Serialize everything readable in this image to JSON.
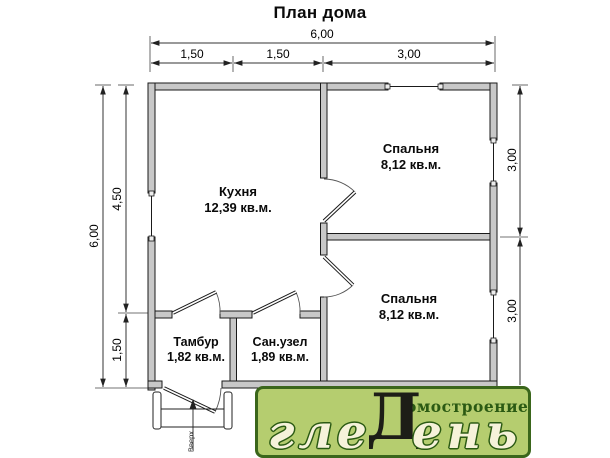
{
  "title": "План дома",
  "dims": {
    "top_total": "6,00",
    "top_seg1": "1,50",
    "top_seg2": "1,50",
    "top_seg3": "3,00",
    "left_total": "6,00",
    "left_seg1": "4,50",
    "left_seg2": "1,50",
    "right_seg1": "3,00",
    "right_seg2": "3,00"
  },
  "rooms": {
    "kitchen": {
      "name": "Кухня",
      "area": "12,39 кв.м."
    },
    "bedroom1": {
      "name": "Спальня",
      "area": "8,12 кв.м."
    },
    "bedroom2": {
      "name": "Спальня",
      "area": "8,12 кв.м."
    },
    "tambour": {
      "name": "Тамбур",
      "area": "1,82 кв.м."
    },
    "bathroom": {
      "name": "Сан.узел",
      "area": "1,89 кв.м."
    }
  },
  "stairs": {
    "direction_label": "Вверх"
  },
  "logo": {
    "brand_part1": "гле",
    "brand_letter_d": "Д",
    "brand_part2": "ень",
    "subtitle": "омостроение",
    "bg_color": "#b5cd6f",
    "border_color": "#3a661b",
    "letter_color": "#f6f2da",
    "dark_letter_color": "#1d1e17",
    "subtitle_color": "#2b5a13"
  },
  "colors": {
    "wall_fill": "#c8c8c8",
    "line_color": "#222222"
  }
}
